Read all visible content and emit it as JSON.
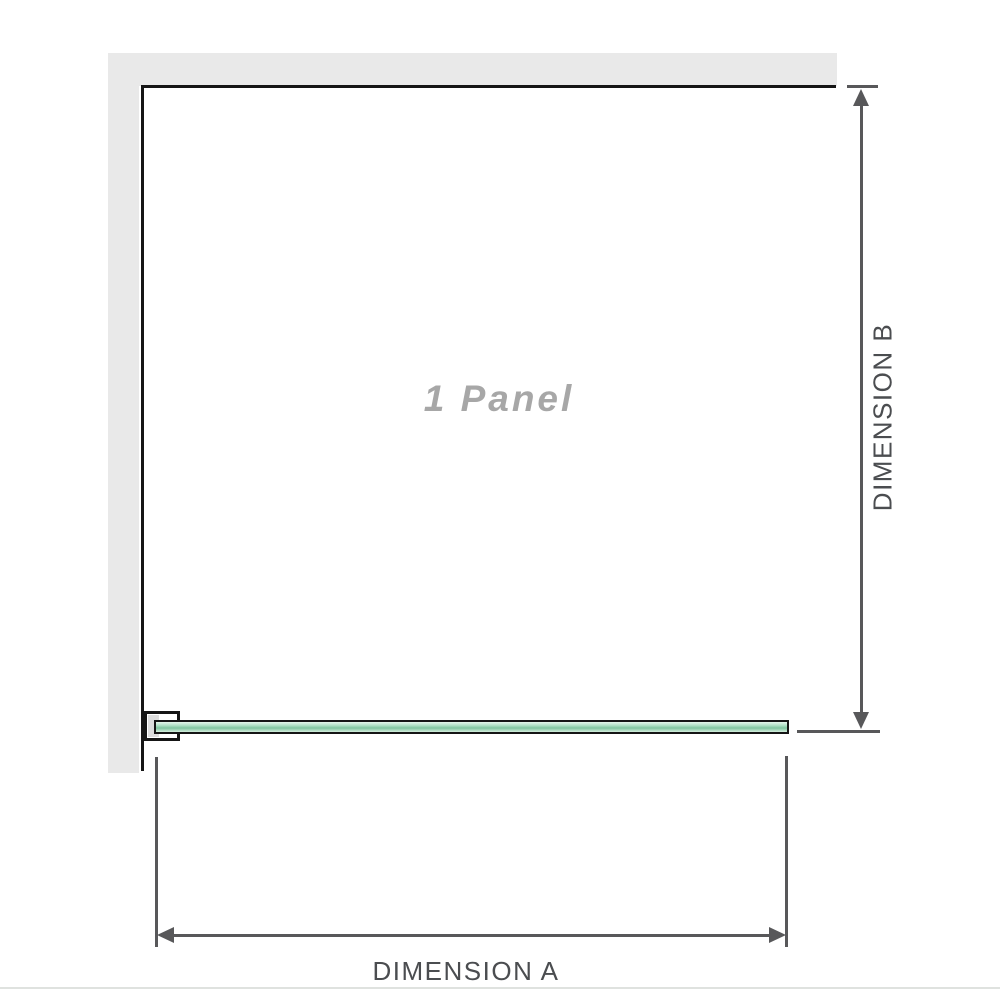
{
  "diagram": {
    "panel_label": "1 Panel",
    "dimension_a_label": "DIMENSION A",
    "dimension_b_label": "DIMENSION B"
  },
  "icons": {
    "arrow_up": "css-triangle-up",
    "arrow_down": "css-triangle-down",
    "arrow_left": "css-triangle-left",
    "arrow_right": "css-triangle-right"
  },
  "colors": {
    "wall": "#e9e9e9",
    "wall_edge": "#151515",
    "bracket_fill": "#dcdcdc",
    "glass_top": "#e6f5ec",
    "glass_mid": "#aee0c4",
    "glass_deep": "#7fc49f",
    "glass_bottom": "#d3eedd",
    "dimension_line": "#58585a",
    "label_text": "#4b4d50",
    "panel_text": "#a7a7a7",
    "separator": "#dfe2df"
  }
}
